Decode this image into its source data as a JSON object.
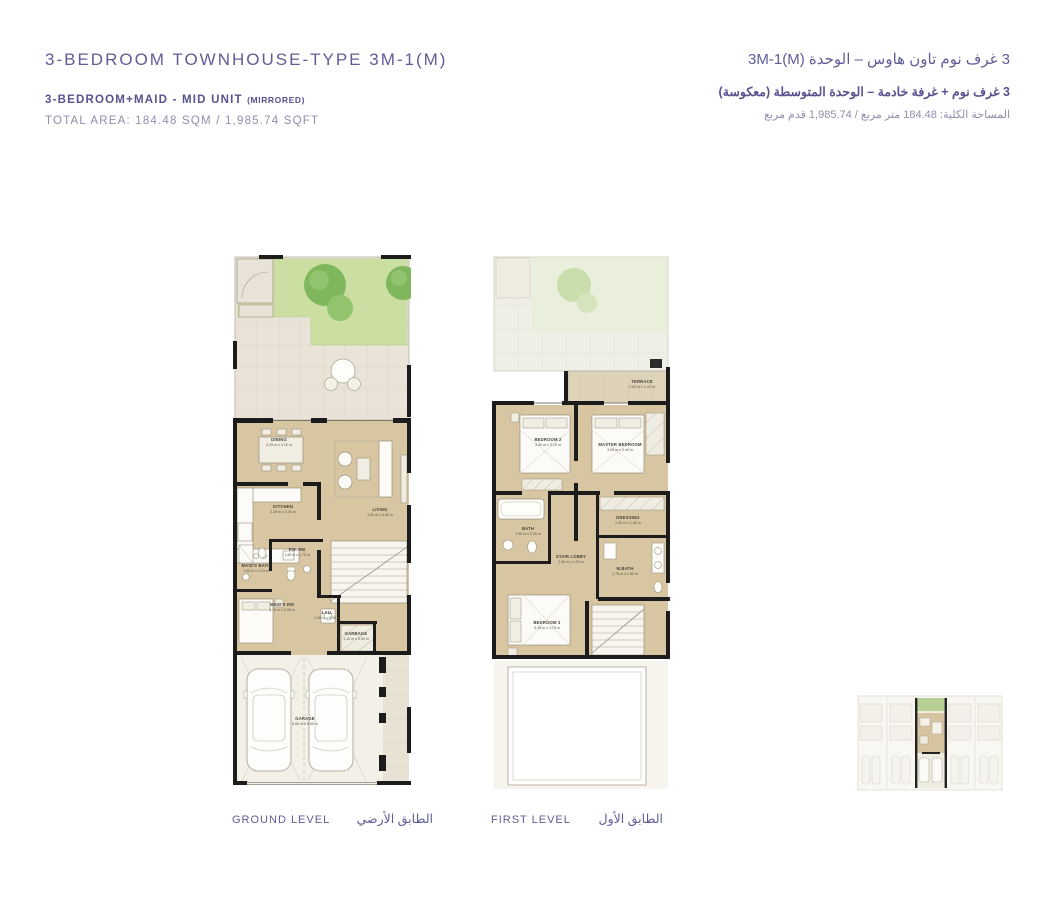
{
  "header": {
    "en": {
      "title": "3-BEDROOM TOWNHOUSE-TYPE 3M-1(M)",
      "subtitle": "3-BEDROOM+MAID - MID UNIT",
      "subtitle_note": "(MIRRORED)",
      "total_area": "TOTAL AREA: 184.48 SQM / 1,985.74 SQFT"
    },
    "ar": {
      "title": "3 غرف نوم تاون هاوس – الوحدة 3M-1(M)",
      "subtitle": "3 غرف نوم + غرفة خادمة – الوحدة المتوسطة (معكوسة)",
      "total_area": "المساحة الكلية: 184.48 متر مربع / 1,985.74 قدم مربع"
    }
  },
  "ground_level": {
    "label_en": "GROUND LEVEL",
    "label_ar": "الطابق الأرضي",
    "rooms": {
      "dining": {
        "name": "DINING",
        "dims": "3.25 m x 3.10 m"
      },
      "kitchen": {
        "name": "KITCHEN",
        "dims": "3.15 m x 2.40 m"
      },
      "living": {
        "name": "LIVING",
        "dims": "3.50 m x 5.49 m"
      },
      "pw_rm": {
        "name": "PW. RM",
        "dims": "1.45 m x 1.75 m"
      },
      "maids_bath": {
        "name": "MAID'S BATH",
        "dims": "1.05 m x 2.15 m"
      },
      "maids_rm": {
        "name": "MAID'S RM",
        "dims": "3.15 m x 2.30 m"
      },
      "lau": {
        "name": "LAU.",
        "dims": "1.35 m x 0.90 m"
      },
      "garbage": {
        "name": "GARBAGE",
        "dims": "1.15 m x 0.90 m"
      },
      "garage": {
        "name": "GARAGE",
        "dims": "5.60 m x 5.50 m"
      }
    }
  },
  "first_level": {
    "label_en": "FIRST LEVEL",
    "label_ar": "الطابق الأول",
    "rooms": {
      "terrace": {
        "name": "TERRACE",
        "dims": "2.00 m x 1.20 m"
      },
      "bedroom2": {
        "name": "BEDROOM 2",
        "dims": "3.40 m x 3.15 m"
      },
      "master": {
        "name": "MASTER BEDROOM",
        "dims": "3.05 m x 3.40 m"
      },
      "bath": {
        "name": "BATH",
        "dims": "1.95 m x 2.30 m"
      },
      "stair_lobby": {
        "name": "STAIR LOBBY",
        "dims": "2.30 m x 1.20 m"
      },
      "dressing": {
        "name": "DRESSING",
        "dims": "2.30 m x 1.05 m"
      },
      "m_bath": {
        "name": "M.BATH",
        "dims": "2.75 m x 1.60 m"
      },
      "bedroom3": {
        "name": "BEDROOM 3",
        "dims": "3.15 m x 3.75 m"
      }
    }
  },
  "colors": {
    "accent_purple": "#5e5c96",
    "floor_tan": "#d7c6a1",
    "lawn_green": "#ccdfa3",
    "wall_black": "#1c1c1c"
  }
}
